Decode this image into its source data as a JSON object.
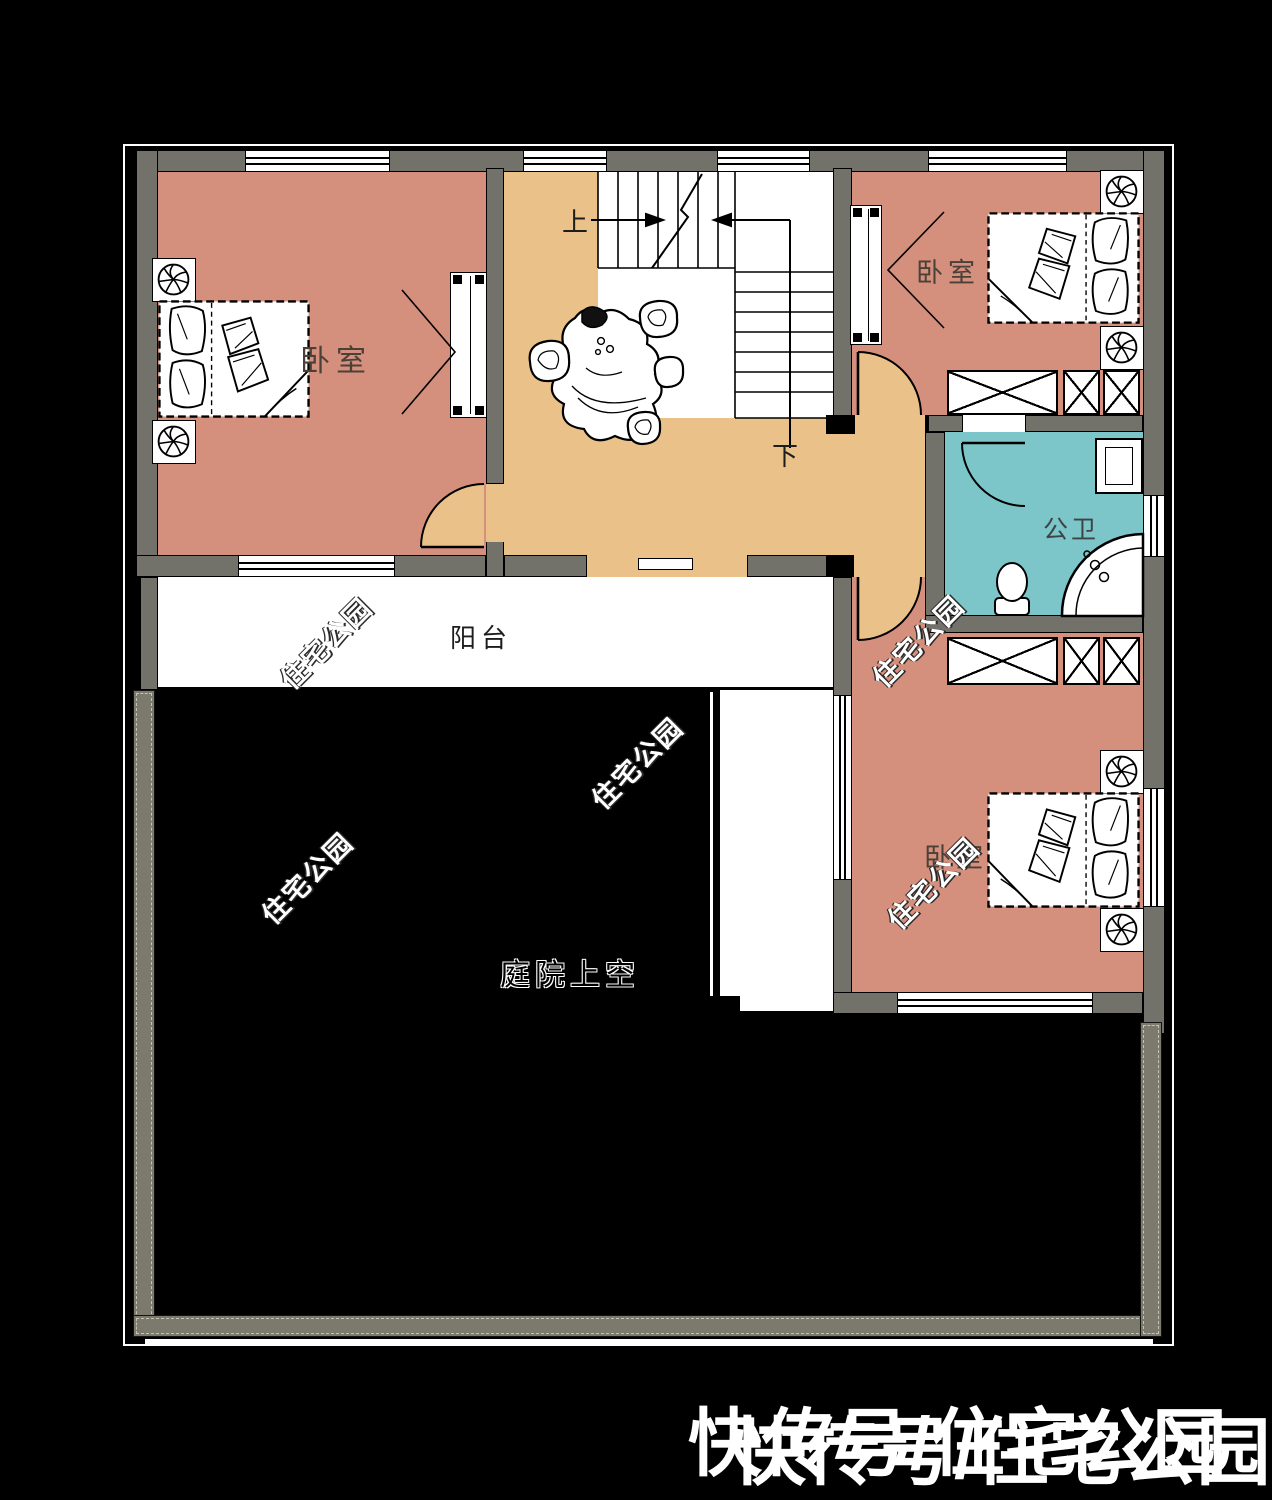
{
  "plan": {
    "rooms": {
      "bedroom_top_left": "卧室",
      "bedroom_top_right": "卧室",
      "bedroom_bottom_right": "卧室",
      "tea_room": "茶室",
      "bathroom": "公卫",
      "balcony": "阳台",
      "courtyard_void": "庭院上空"
    },
    "stairs": {
      "up": "上",
      "down": "下"
    },
    "watermark_text": "住宅公园",
    "footer_watermark": "快传号/住宅公园",
    "colors": {
      "bedroom_fill": "#d58f7d",
      "hall_fill": "#eac289",
      "bathroom_fill": "#7cc5c8",
      "balcony_fill": "#ffffff",
      "wall": "#73726a",
      "background": "#000000"
    }
  }
}
